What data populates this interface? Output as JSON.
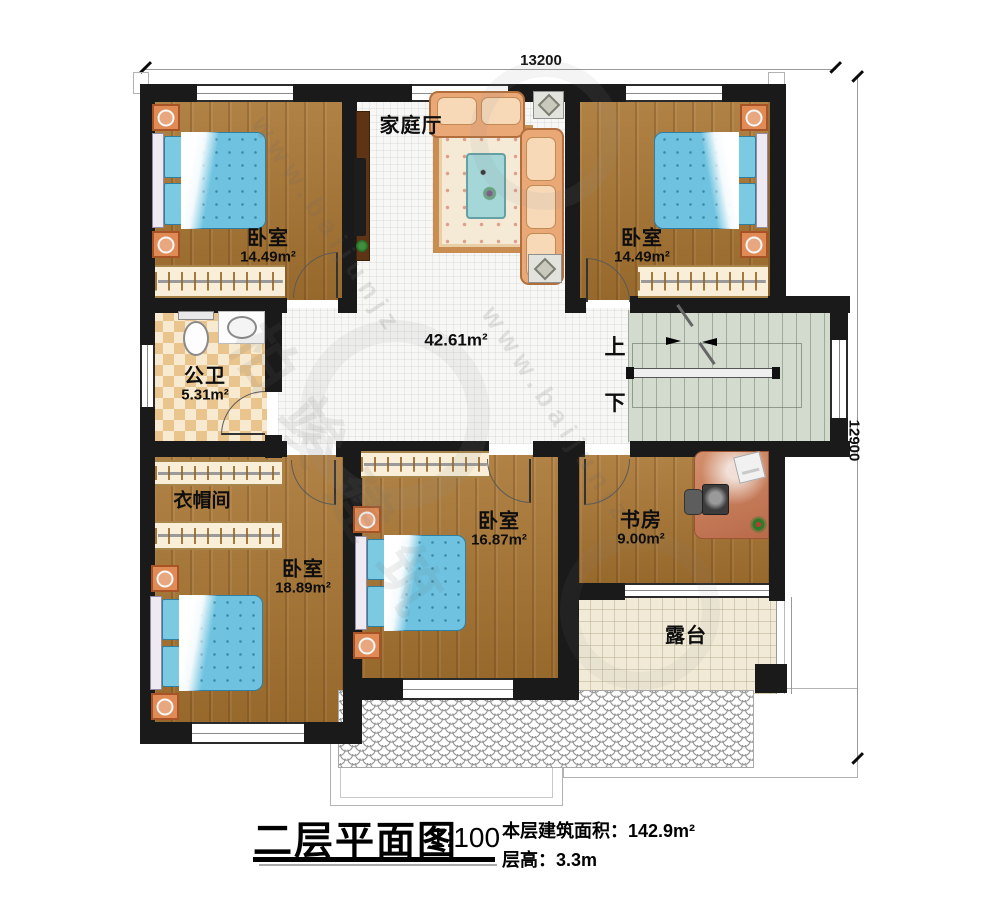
{
  "dimensions": {
    "top": "13200",
    "right": "12900"
  },
  "rooms": {
    "bedroom_top_left": {
      "name": "卧室",
      "area": "14.49m²"
    },
    "bedroom_top_right": {
      "name": "卧室",
      "area": "14.49m²"
    },
    "family_hall": {
      "name": "家庭厅"
    },
    "hall_open_area": {
      "area": "42.61m²"
    },
    "bathroom": {
      "name": "公卫",
      "area": "5.31m²"
    },
    "cloakroom": {
      "name": "衣帽间"
    },
    "bedroom_bottom_left": {
      "name": "卧室",
      "area": "18.89m²"
    },
    "bedroom_bottom_middle": {
      "name": "卧室",
      "area": "16.87m²"
    },
    "study": {
      "name": "书房",
      "area": "9.00m²"
    },
    "terrace": {
      "name": "露台"
    }
  },
  "stairs": {
    "up_label": "上",
    "down_label": "下"
  },
  "title_block": {
    "title": "二层平面图",
    "scale": "1:100",
    "area_line": "本层建筑面积：142.9m²",
    "height_line": "层高：3.3m"
  },
  "watermark": {
    "site": "www.baijunjz",
    "brand": "柏竣建筑"
  },
  "colors": {
    "wall": "#1a1a1a",
    "wood_floor": "#a87430",
    "stair_floor": "#d3dbce",
    "bed_blue": "#6fc3e0",
    "sofa_peach": "#eaa876",
    "checker_tan": "#e9c58d"
  }
}
